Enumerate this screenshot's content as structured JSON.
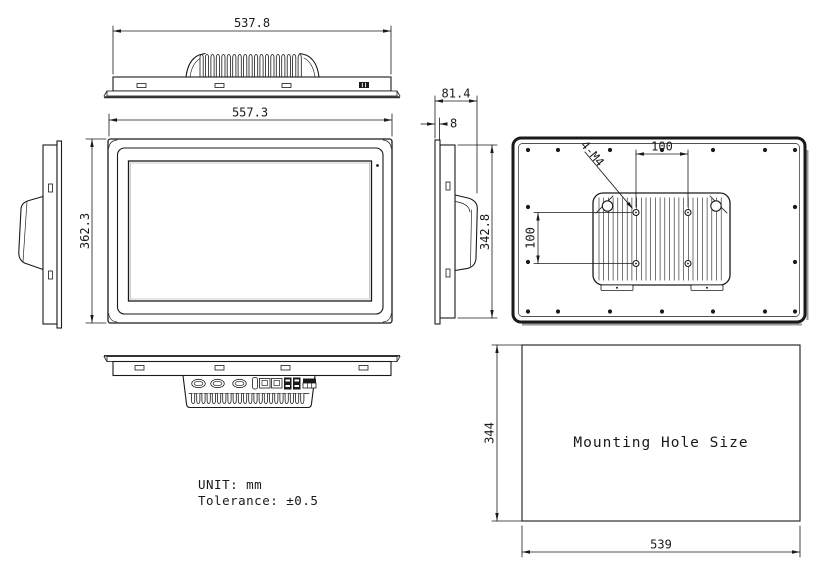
{
  "views": {
    "top": {
      "width_dim": "537.8"
    },
    "front": {
      "width_dim": "557.3",
      "height_dim": "362.3"
    },
    "right_side": {
      "depth_dim": "81.4",
      "bezel_dim": "8",
      "height_dim": "342.8"
    },
    "rear": {
      "vesa_horizontal_dim": "100",
      "vesa_vertical_dim": "100",
      "screw_label": "4-M4"
    },
    "mounting_hole": {
      "label": "Mounting Hole Size",
      "width_dim": "539",
      "height_dim": "344"
    }
  },
  "notes": {
    "unit": "UNIT: mm",
    "tolerance": "Tolerance: ±0.5"
  },
  "colors": {
    "line": "#1a1a1a",
    "background": "#ffffff"
  }
}
